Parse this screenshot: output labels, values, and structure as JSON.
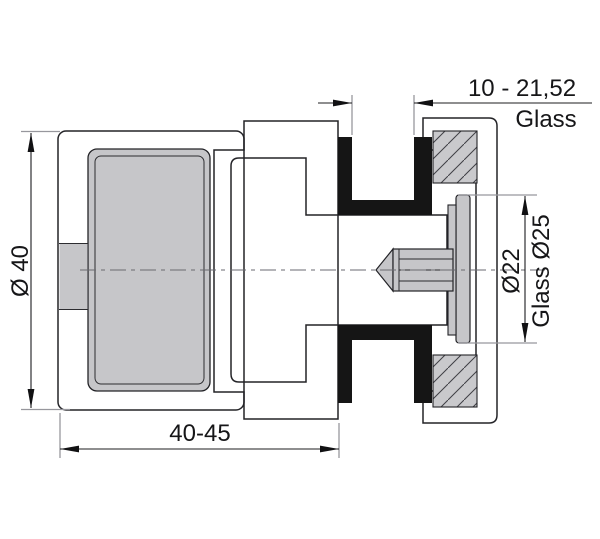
{
  "drawing": {
    "type": "technical-cross-section",
    "subject": "glass-clamp-fitting",
    "labels": {
      "glass_thickness": "10 - 21,52",
      "glass_word": "Glass",
      "body_diameter": "Ø 40",
      "boss_diameter": "Ø22",
      "glass_hole_diameter": "Glass Ø25",
      "body_length": "40-45"
    },
    "colors": {
      "background": "#ffffff",
      "metal_fill": "#c9c9cc",
      "cavity_fill": "#c6c6c9",
      "hatch_stroke": "#3f3f44",
      "part_outline": "#232327",
      "gasket": "#151515",
      "dimension_line": "#1d1d1f",
      "extension_line": "#97979d",
      "centerline": "#6a6a70"
    }
  }
}
